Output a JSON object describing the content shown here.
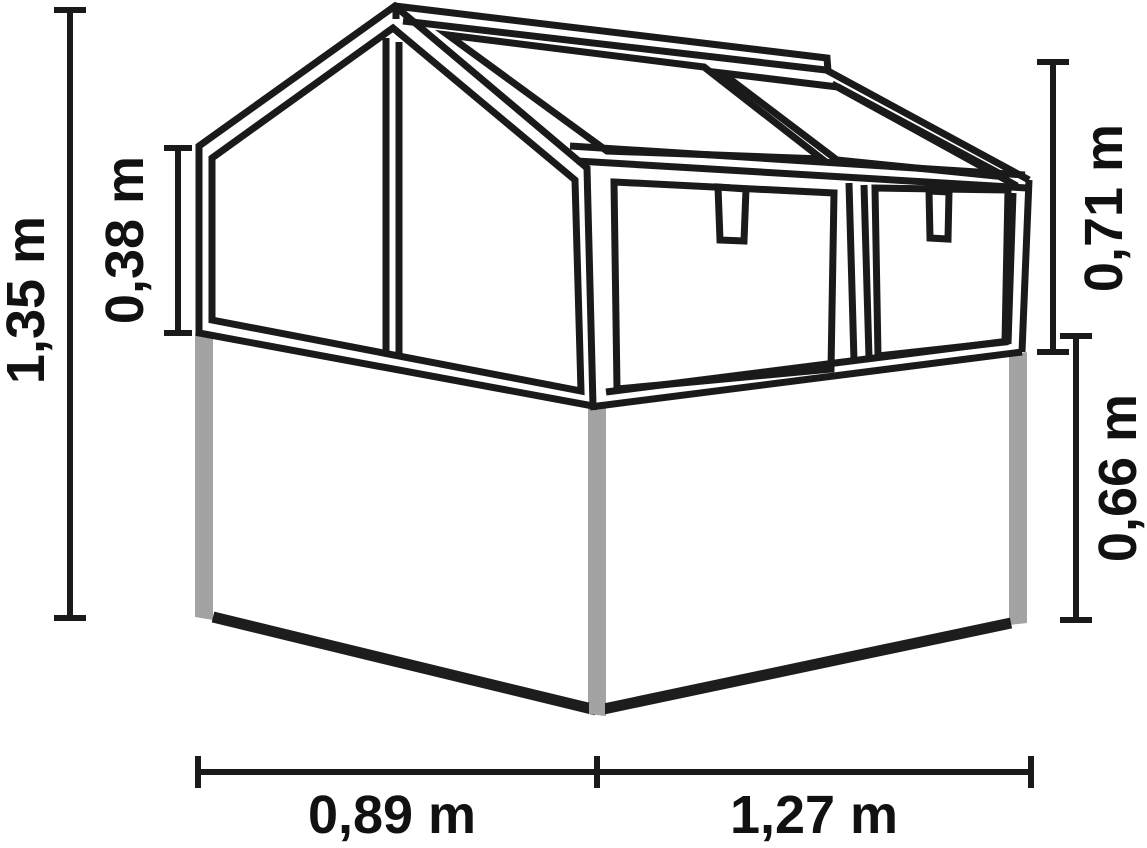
{
  "diagram": {
    "subject": "greenhouse-cold-frame-dimension-drawing",
    "unit": "m",
    "dimensions": {
      "total_height": {
        "label": "1,35 m",
        "value": 1.35,
        "unit": "m",
        "orientation": "vertical",
        "side": "left-outer"
      },
      "glass_side_height": {
        "label": "0,38 m",
        "value": 0.38,
        "unit": "m",
        "orientation": "vertical",
        "side": "left-inner"
      },
      "glass_front_height": {
        "label": "0,71 m",
        "value": 0.71,
        "unit": "m",
        "orientation": "vertical",
        "side": "right-upper"
      },
      "base_height": {
        "label": "0,66 m",
        "value": 0.66,
        "unit": "m",
        "orientation": "vertical",
        "side": "right-lower"
      },
      "side_depth": {
        "label": "0,89 m",
        "value": 0.89,
        "unit": "m",
        "orientation": "horizontal",
        "side": "bottom-left"
      },
      "front_width": {
        "label": "1,27 m",
        "value": 1.27,
        "unit": "m",
        "orientation": "horizontal",
        "side": "bottom-right"
      }
    }
  },
  "colors": {
    "line": "#1a1a1a",
    "post": "#a3a3a3",
    "base-edge": "#1d1d1d",
    "background": "#ffffff",
    "text": "#111111"
  }
}
